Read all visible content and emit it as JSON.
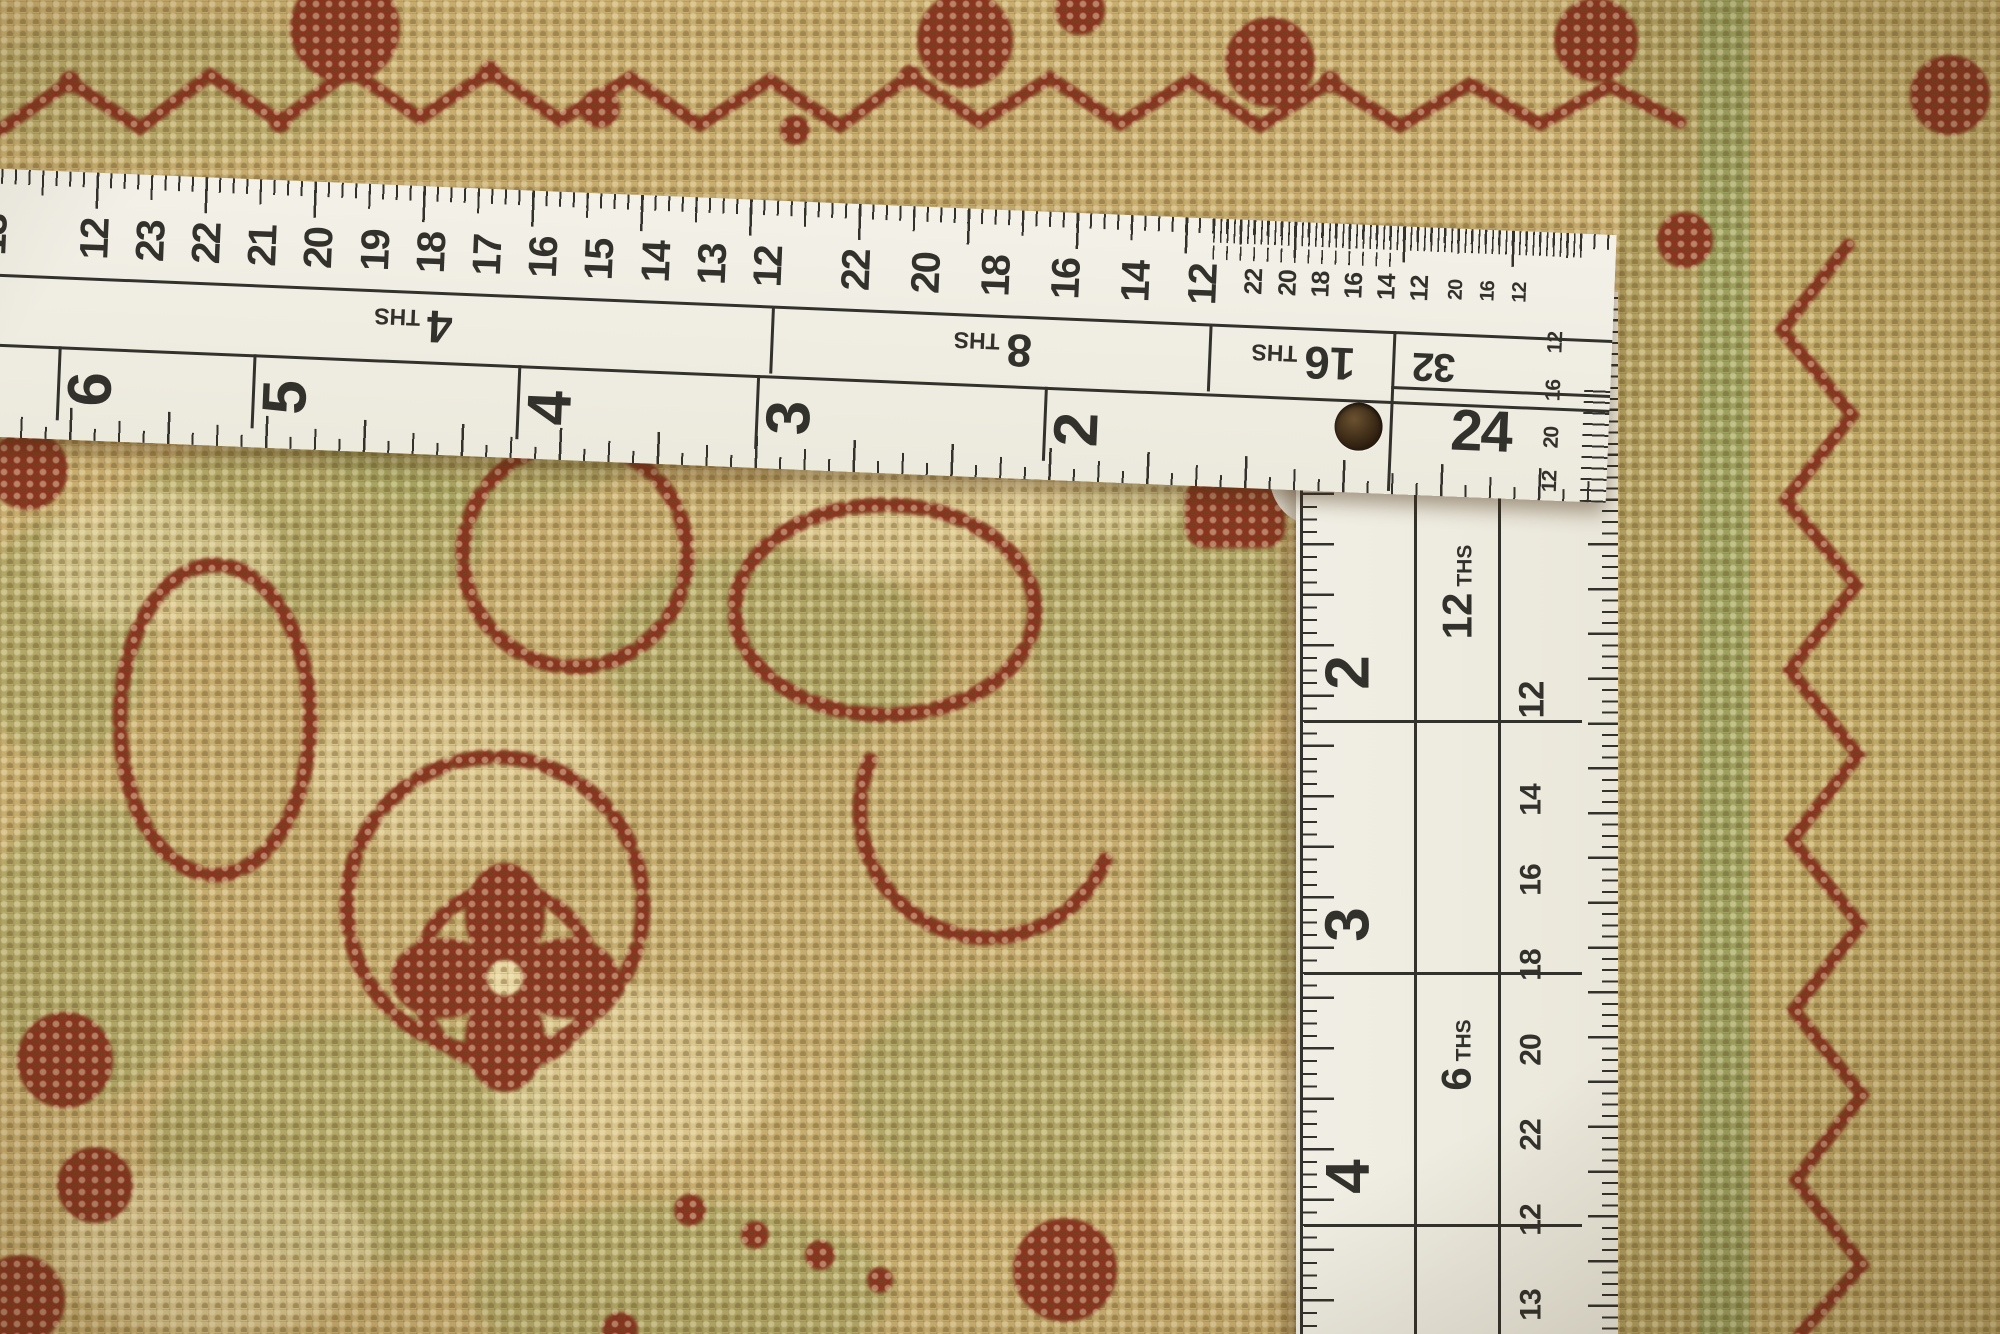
{
  "colors": {
    "ruler-face": "#f0eee4",
    "ruler-print": "#33312c",
    "rug-base": "#c8ad6e",
    "rug-shadow": "#8a7440",
    "rug-cream": "#ead9a4",
    "rug-olive": "#9da15e",
    "rug-red": "#8a3520",
    "rug-red-dark": "#6e2918"
  },
  "ruler": {
    "top_numbers": [
      {
        "t": "13",
        "x": -6
      },
      {
        "t": "12",
        "x": 96
      },
      {
        "t": "23",
        "x": 152
      },
      {
        "t": "22",
        "x": 208
      },
      {
        "t": "21",
        "x": 264
      },
      {
        "t": "20",
        "x": 320
      },
      {
        "t": "19",
        "x": 377
      },
      {
        "t": "18",
        "x": 433
      },
      {
        "t": "17",
        "x": 489
      },
      {
        "t": "16",
        "x": 545
      },
      {
        "t": "15",
        "x": 601
      },
      {
        "t": "14",
        "x": 658
      },
      {
        "t": "13",
        "x": 714
      },
      {
        "t": "12",
        "x": 770
      },
      {
        "t": "22",
        "x": 858
      },
      {
        "t": "20",
        "x": 928
      },
      {
        "t": "18",
        "x": 998
      },
      {
        "t": "16",
        "x": 1068
      },
      {
        "t": "14",
        "x": 1138
      },
      {
        "t": "12",
        "x": 1205
      },
      {
        "t": "22",
        "x": 1256,
        "c": "sm"
      },
      {
        "t": "20",
        "x": 1290,
        "c": "sm"
      },
      {
        "t": "18",
        "x": 1323,
        "c": "sm"
      },
      {
        "t": "16",
        "x": 1356,
        "c": "sm"
      },
      {
        "t": "14",
        "x": 1389,
        "c": "sm"
      },
      {
        "t": "12",
        "x": 1422,
        "c": "sm"
      },
      {
        "t": "20",
        "x": 1458,
        "c": "xs"
      },
      {
        "t": "16",
        "x": 1490,
        "c": "xs"
      },
      {
        "t": "12",
        "x": 1522,
        "c": "xs"
      }
    ],
    "ths_sections": [
      {
        "n": "4",
        "suffix": "THS",
        "x": 80,
        "w": 715,
        "c": "first"
      },
      {
        "n": "8",
        "suffix": "THS",
        "x": 795,
        "w": 438
      },
      {
        "n": "16",
        "suffix": "THS",
        "x": 1233,
        "w": 184
      }
    ],
    "inch_numbers": [
      {
        "t": "6",
        "x": 88,
        "line": 1
      },
      {
        "t": "5",
        "x": 283,
        "line": 1
      },
      {
        "t": "4",
        "x": 548,
        "line": 1
      },
      {
        "t": "3",
        "x": 787,
        "line": 1
      },
      {
        "t": "2",
        "x": 1075,
        "line": 1
      }
    ],
    "corner": {
      "n32": "32",
      "n24": "24",
      "right_column": [
        {
          "t": "12",
          "y": 92
        },
        {
          "t": "16",
          "y": 140
        },
        {
          "t": "20",
          "y": 187
        },
        {
          "t": "12",
          "y": 231
        }
      ]
    },
    "side": {
      "inch_lines": [
        {
          "t": "",
          "y": 178,
          "line": 1
        },
        {
          "t": "2",
          "y": 428,
          "line": 1
        },
        {
          "t": "3",
          "y": 680,
          "line": 1
        },
        {
          "t": "4",
          "y": 932,
          "line": 1
        }
      ],
      "ths_labels": [
        {
          "n": "12",
          "suffix": "THS",
          "y": 300
        },
        {
          "n": "6",
          "suffix": "THS",
          "y": 763
        }
      ],
      "numbers": [
        {
          "t": "12",
          "y": 408,
          "c": "lg"
        },
        {
          "t": "14",
          "y": 508
        },
        {
          "t": "16",
          "y": 588
        },
        {
          "t": "18",
          "y": 673
        },
        {
          "t": "20",
          "y": 758
        },
        {
          "t": "22",
          "y": 843
        },
        {
          "t": "12",
          "y": 928
        },
        {
          "t": "13",
          "y": 1013
        }
      ]
    }
  }
}
